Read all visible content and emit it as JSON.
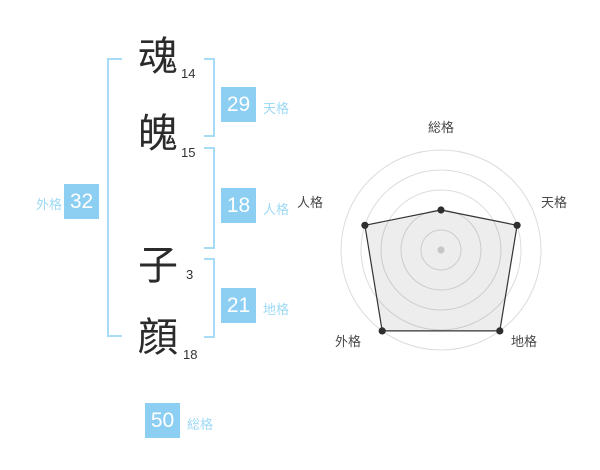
{
  "title": "姓名判断 画数表示",
  "characters": [
    {
      "char": "魂",
      "strokes": "14"
    },
    {
      "char": "魄",
      "strokes": "15"
    },
    {
      "char": "子",
      "strokes": "3"
    },
    {
      "char": "顔",
      "strokes": "18"
    }
  ],
  "gokaku": [
    {
      "id": "tenkaku",
      "label": "天格",
      "value": "29"
    },
    {
      "id": "jinkaku",
      "label": "人格",
      "value": "18"
    },
    {
      "id": "chikaku",
      "label": "地格",
      "value": "21"
    },
    {
      "id": "gaikaku",
      "label": "外格",
      "value": "32"
    },
    {
      "id": "soukaku",
      "label": "総格",
      "value": "50"
    }
  ],
  "colors": {
    "accent_blue_box": "#8dcff2",
    "accent_blue_label": "#9ed9f6",
    "accent_blue_bracket": "#a6dcf6",
    "text_dark": "#2b2b2b",
    "radar_grid": "#dcdcdc",
    "radar_line": "#333333"
  },
  "chart_data": {
    "type": "radar",
    "categories": [
      "総格",
      "天格",
      "地格",
      "外格",
      "人格"
    ],
    "values_percent": [
      40,
      80,
      100,
      100,
      80
    ],
    "max": 100,
    "grid_levels": [
      20,
      40,
      60,
      80,
      100
    ],
    "start_angle_deg": 90,
    "direction": "clockwise",
    "grid_shape": "circle",
    "spokes": false,
    "legend": "none",
    "title": ""
  }
}
